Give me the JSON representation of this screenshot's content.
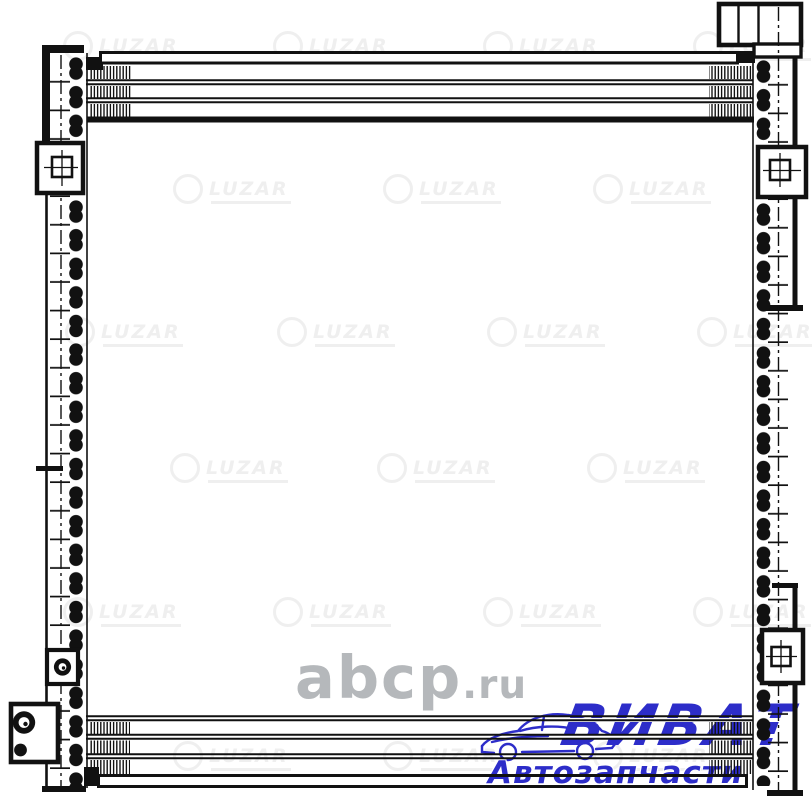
{
  "page": {
    "background_color": "#ffffff"
  },
  "drawing": {
    "name": "LUZAR air-conditioning condenser technical line drawing",
    "line_color": "#111111",
    "features": {
      "left_tank": "vertical tank with dash-dot centerline",
      "right_tank": "vertical tank with dash-dot centerline",
      "top_connector_block": "three-cell fitting block",
      "brackets": "square mounting brackets with square and round holes",
      "bottom_left_fitting": "port block with large and small circular openings",
      "core": "flat tube rows with corrugated fin hatching top and bottom"
    }
  },
  "watermarks": {
    "brand": {
      "label": "LUZAR",
      "color": "#efefef",
      "tiles": [
        [
          63,
          31
        ],
        [
          273,
          31
        ],
        [
          483,
          31
        ],
        [
          693,
          31
        ],
        [
          173,
          174
        ],
        [
          383,
          174
        ],
        [
          593,
          174
        ],
        [
          65,
          317
        ],
        [
          277,
          317
        ],
        [
          487,
          317
        ],
        [
          697,
          317
        ],
        [
          170,
          453
        ],
        [
          377,
          453
        ],
        [
          587,
          453
        ],
        [
          63,
          597
        ],
        [
          273,
          597
        ],
        [
          483,
          597
        ],
        [
          693,
          597
        ],
        [
          173,
          741
        ],
        [
          383,
          741
        ],
        [
          593,
          741
        ]
      ]
    },
    "site": {
      "name": "abcp",
      "tld": ".ru",
      "color": "#b5b8bb"
    }
  },
  "logo": {
    "title": "ВИВАТ",
    "subtitle": "Автозапчасти",
    "color": "#2d2dc9",
    "icon": "car-outline-icon"
  }
}
